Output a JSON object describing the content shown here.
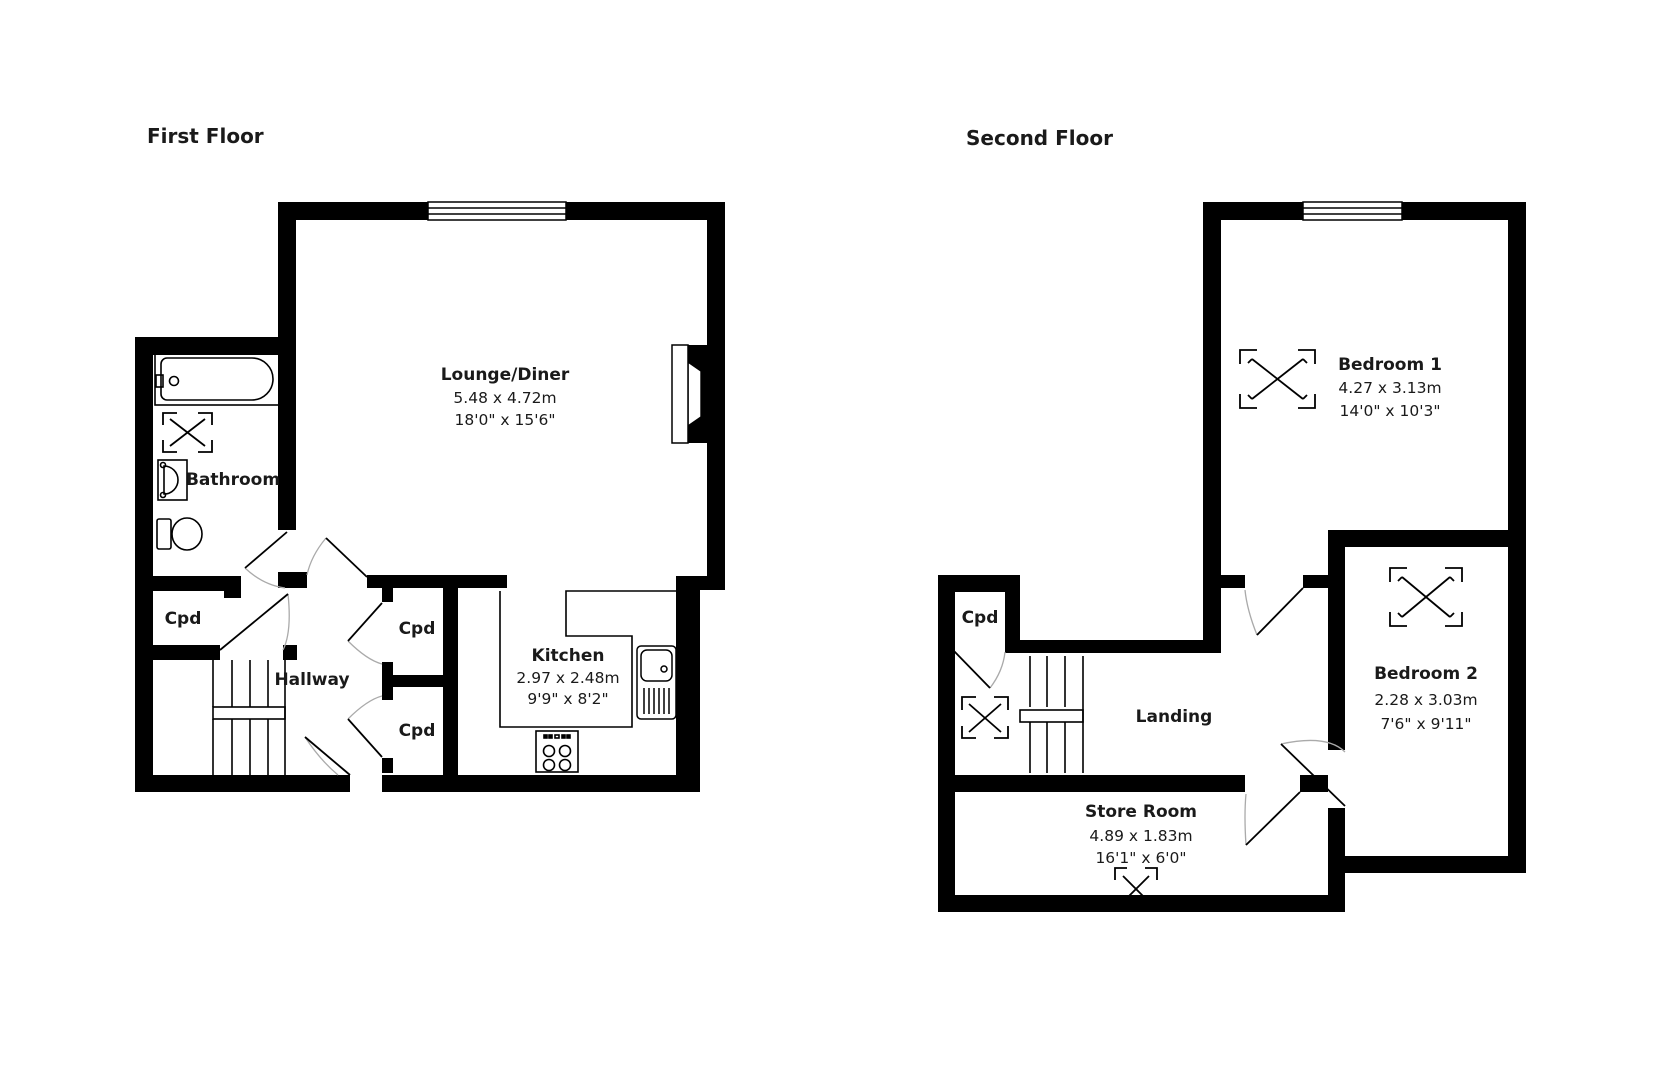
{
  "document": {
    "type": "floorplan"
  },
  "colors": {
    "wall": "#000000",
    "background": "#ffffff",
    "door_arc": "#aaaaaa",
    "text": "#1a1a1a"
  },
  "first_floor": {
    "title": "First Floor",
    "rooms": {
      "lounge": {
        "name": "Lounge/Diner",
        "dim_m": "5.48 x 4.72m",
        "dim_ft": "18'0\" x 15'6\""
      },
      "kitchen": {
        "name": "Kitchen",
        "dim_m": "2.97 x 2.48m",
        "dim_ft": "9'9\" x 8'2\""
      },
      "bathroom": {
        "name": "Bathroom"
      },
      "hallway": {
        "name": "Hallway"
      },
      "cpd_left": {
        "name": "Cpd"
      },
      "cpd_mid_upper": {
        "name": "Cpd"
      },
      "cpd_mid_lower": {
        "name": "Cpd"
      }
    }
  },
  "second_floor": {
    "title": "Second Floor",
    "rooms": {
      "bedroom1": {
        "name": "Bedroom 1",
        "dim_m": "4.27 x 3.13m",
        "dim_ft": "14'0\" x 10'3\""
      },
      "bedroom2": {
        "name": "Bedroom 2",
        "dim_m": "2.28 x 3.03m",
        "dim_ft": "7'6\" x 9'11\""
      },
      "landing": {
        "name": "Landing"
      },
      "store": {
        "name": "Store Room",
        "dim_m": "4.89 x 1.83m",
        "dim_ft": "16'1\" x 6'0\""
      },
      "cpd": {
        "name": "Cpd"
      }
    }
  }
}
